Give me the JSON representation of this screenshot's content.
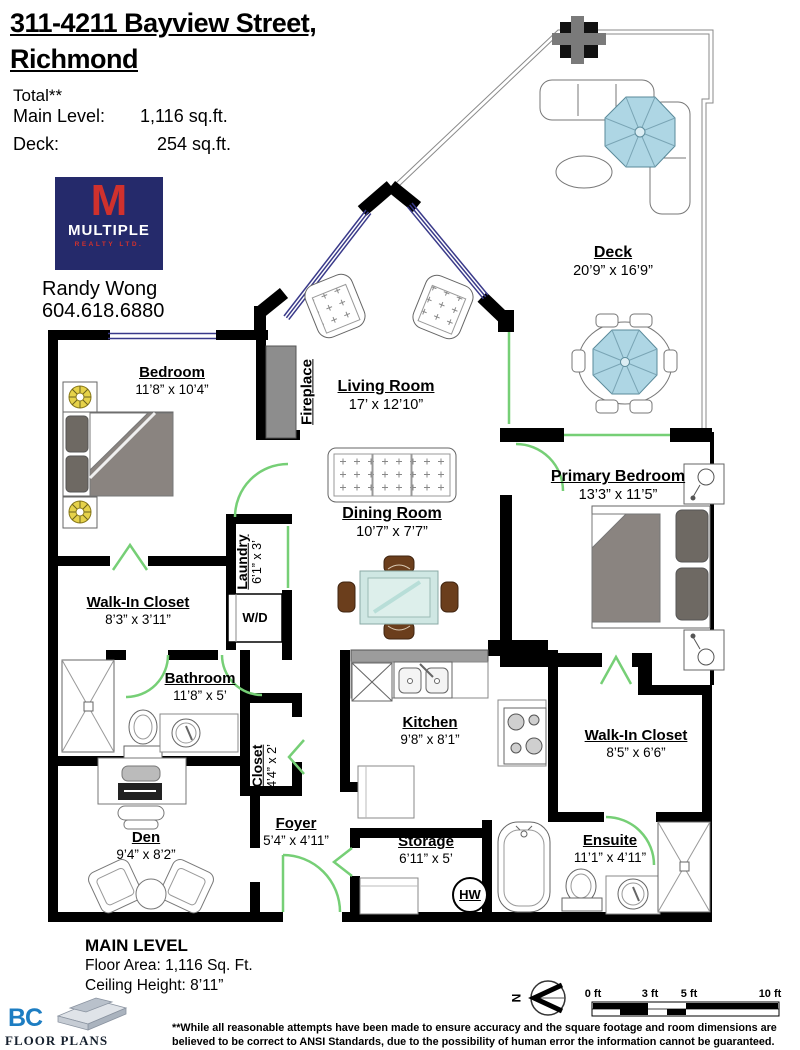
{
  "header": {
    "title_line1": "311-4211 Bayview Street,",
    "title_line2": "Richmond",
    "total_label": "Total**",
    "rows": [
      {
        "label": "Main Level:",
        "value": "1,116 sq.ft."
      },
      {
        "label": "Deck:",
        "value": "254 sq.ft."
      }
    ]
  },
  "agent": {
    "logo_letter": "M",
    "logo_name": "MULTIPLE",
    "logo_sub": "REALTY LTD.",
    "name": "Randy Wong",
    "phone": "604.618.6880"
  },
  "rooms": {
    "deck": {
      "name": "Deck",
      "dims": "20’9” x 16’9”"
    },
    "bedroom": {
      "name": "Bedroom",
      "dims": "11’8” x 10’4”"
    },
    "living_room": {
      "name": "Living Room",
      "dims": "17’ x 12’10”"
    },
    "dining_room": {
      "name": "Dining Room",
      "dims": "10’7” x 7’7”"
    },
    "primary_bedroom": {
      "name": "Primary Bedroom",
      "dims": "13’3” x 11’5”"
    },
    "walk_in_closet_left": {
      "name": "Walk-In Closet",
      "dims": "8’3” x 3’11”"
    },
    "laundry": {
      "name": "Laundry",
      "dims": "6’1” x 3’"
    },
    "bathroom": {
      "name": "Bathroom",
      "dims": "11’8” x 5’"
    },
    "kitchen": {
      "name": "Kitchen",
      "dims": "9’8” x 8’1”"
    },
    "walk_in_closet_right": {
      "name": "Walk-In Closet",
      "dims": "8’5” x 6’6”"
    },
    "closet": {
      "name": "Closet",
      "dims": "4’4” x 2’"
    },
    "den": {
      "name": "Den",
      "dims": "9’4” x 8’2”"
    },
    "foyer": {
      "name": "Foyer",
      "dims": "5’4” x 4’11”"
    },
    "storage": {
      "name": "Storage",
      "dims": "6’11” x 5’"
    },
    "ensuite": {
      "name": "Ensuite",
      "dims": "11’1” x 4’11”"
    },
    "fireplace": {
      "name": "Fireplace"
    },
    "washer_dryer": "W/D",
    "hot_water": "HW"
  },
  "footer": {
    "level_title": "MAIN LEVEL",
    "floor_area": "Floor Area: 1,116 Sq. Ft.",
    "ceiling_height": "Ceiling Height: 8’11”",
    "compass_label": "N",
    "scale_ticks": [
      "0 ft",
      "3 ft",
      "5 ft",
      "10 ft"
    ],
    "logo_bc": "BC",
    "logo_floorplans": "FLOOR PLANS",
    "disclaimer_line1": "**While all reasonable attempts have been made to ensure accuracy and the square footage and room dimensions are believed to",
    "disclaimer_line2": "be correct to ANSI Standards, due to the possibility of human error the information cannot be guaranteed. E&O Insured for $1,000,000"
  },
  "colors": {
    "wall": "#000000",
    "door_green": "#76cf76",
    "window_blue": "#3a3a8a",
    "umbrella_blue": "#aed6e4",
    "glass_table_teal": "#cfe7e3",
    "furniture_gray": "#8a8480",
    "logo_navy": "#252a6b",
    "logo_red": "#d0312d",
    "bc_blue": "#1d7dc2"
  }
}
